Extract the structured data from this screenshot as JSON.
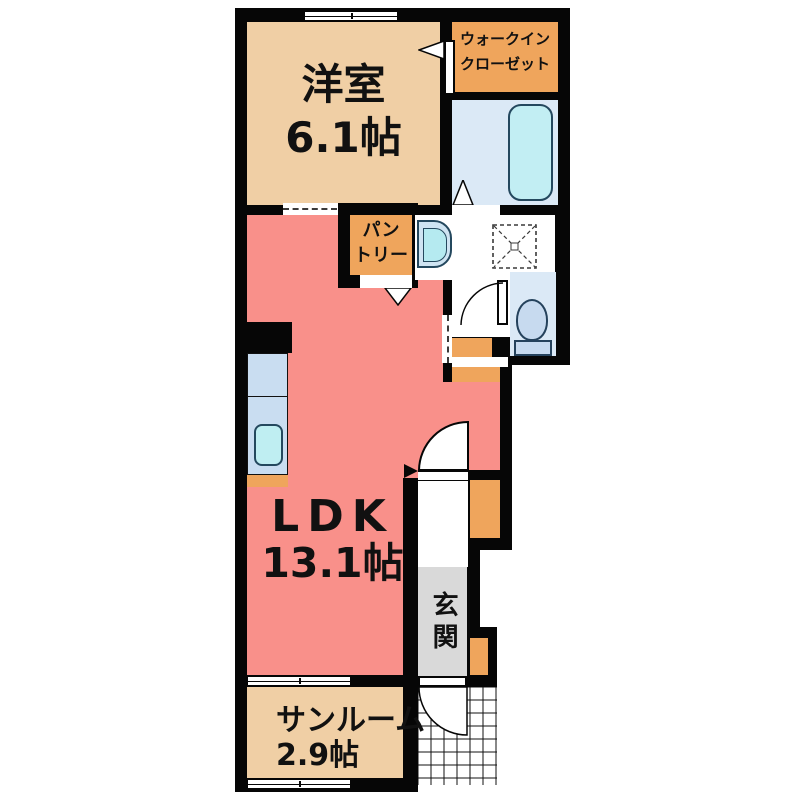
{
  "floorplan": {
    "title": "1LDK apartment floor plan",
    "rooms": {
      "western_room": {
        "label": "洋室",
        "area": "6.1帖"
      },
      "walk_in_closet": {
        "label_line1": "ウォークイン",
        "label_line2": "クローゼット"
      },
      "pantry": {
        "label_line1": "パン",
        "label_line2": "トリー"
      },
      "ldk": {
        "label": "LDK",
        "area": "13.1帖"
      },
      "entrance": {
        "label": "玄関"
      },
      "sunroom": {
        "label": "サンルーム",
        "area": "2.9帖"
      }
    },
    "fixtures": [
      "bathtub",
      "bathroom",
      "washbasin",
      "washing-machine-space",
      "toilet",
      "kitchen-counter",
      "kitchen-sink",
      "shoe-cabinet",
      "entry-porch-tiles",
      "hinged-doors",
      "sliding-doors",
      "windows"
    ],
    "colors": {
      "wall": "#060606",
      "room_tan": "#f0cfa5",
      "accent_orange": "#efa55c",
      "ldk_salmon": "#f9908a",
      "water_blue": "#dbe9f6",
      "fixture_cyan": "#c2eef3",
      "entrance_gray": "#d9d9d9",
      "background": "#ffffff"
    }
  }
}
